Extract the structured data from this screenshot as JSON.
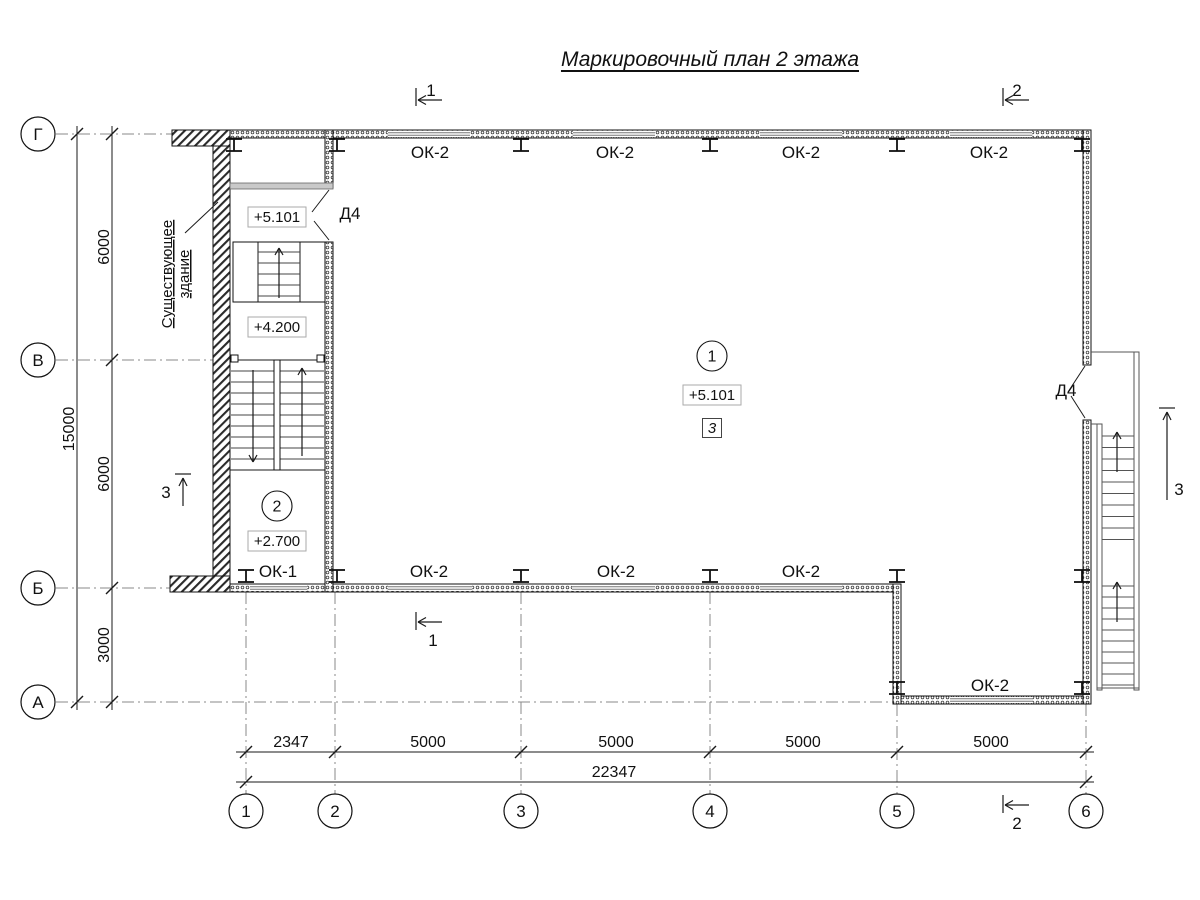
{
  "title": "Маркировочный план 2 этажа",
  "colors": {
    "line": "#1a1a1a",
    "axis_line": "#8a8a8a",
    "wall_hatch": "#2a2a2a"
  },
  "grid": {
    "rows": [
      {
        "label": "Г",
        "y": 134
      },
      {
        "label": "В",
        "y": 360
      },
      {
        "label": "Б",
        "y": 588
      },
      {
        "label": "А",
        "y": 702
      }
    ],
    "cols": [
      {
        "label": "1",
        "x": 246
      },
      {
        "label": "2",
        "x": 335
      },
      {
        "label": "3",
        "x": 521
      },
      {
        "label": "4",
        "x": 710
      },
      {
        "label": "5",
        "x": 897
      },
      {
        "label": "6",
        "x": 1086
      }
    ]
  },
  "dimensions": {
    "left_segments": [
      {
        "text": "6000",
        "y": 247
      },
      {
        "text": "6000",
        "y": 474
      },
      {
        "text": "3000",
        "y": 645
      }
    ],
    "left_overall": {
      "text": "15000",
      "y": 429
    },
    "bottom_segments": [
      {
        "text": "2347",
        "x": 291
      },
      {
        "text": "5000",
        "x": 428
      },
      {
        "text": "5000",
        "x": 616
      },
      {
        "text": "5000",
        "x": 803
      },
      {
        "text": "5000",
        "x": 991
      }
    ],
    "bottom_overall": {
      "text": "22347",
      "x": 614
    }
  },
  "window_marks": [
    {
      "text": "ОК-2",
      "x": 430,
      "y": 152
    },
    {
      "text": "ОК-2",
      "x": 615,
      "y": 152
    },
    {
      "text": "ОК-2",
      "x": 801,
      "y": 152
    },
    {
      "text": "ОК-2",
      "x": 989,
      "y": 152
    },
    {
      "text": "ОК-1",
      "x": 278,
      "y": 571
    },
    {
      "text": "ОК-2",
      "x": 429,
      "y": 571
    },
    {
      "text": "ОК-2",
      "x": 616,
      "y": 571
    },
    {
      "text": "ОК-2",
      "x": 801,
      "y": 571
    },
    {
      "text": "ОК-2",
      "x": 990,
      "y": 685
    }
  ],
  "door_marks": [
    {
      "text": "Д4",
      "x": 350,
      "y": 213
    },
    {
      "text": "Д4",
      "x": 1066,
      "y": 390
    }
  ],
  "level_marks": [
    {
      "text": "+5.101",
      "x": 277,
      "y": 217
    },
    {
      "text": "+4.200",
      "x": 277,
      "y": 327
    },
    {
      "text": "+2.700",
      "x": 277,
      "y": 541
    },
    {
      "text": "+5.101",
      "x": 712,
      "y": 395
    }
  ],
  "room_marks": [
    {
      "text": "1",
      "x": 712,
      "y": 356
    },
    {
      "text": "2",
      "x": 277,
      "y": 506
    }
  ],
  "square_mark": {
    "text": "3",
    "x": 712,
    "y": 428
  },
  "section_marks": [
    {
      "text": "1",
      "orient": "h",
      "tick": [
        416,
        88,
        416,
        106
      ],
      "tail": [
        442,
        100
      ],
      "tip": [
        418,
        100
      ],
      "label": [
        431,
        90
      ]
    },
    {
      "text": "2",
      "orient": "h",
      "tick": [
        1003,
        88,
        1003,
        106
      ],
      "tail": [
        1029,
        100
      ],
      "tip": [
        1005,
        100
      ],
      "label": [
        1017,
        90
      ]
    },
    {
      "text": "1",
      "orient": "h",
      "tick": [
        416,
        612,
        416,
        630
      ],
      "tail": [
        442,
        622
      ],
      "tip": [
        418,
        622
      ],
      "label": [
        433,
        640
      ]
    },
    {
      "text": "2",
      "orient": "h",
      "tick": [
        1003,
        795,
        1003,
        813
      ],
      "tail": [
        1029,
        805
      ],
      "tip": [
        1005,
        805
      ],
      "label": [
        1017,
        823
      ]
    },
    {
      "text": "3",
      "orient": "v",
      "tick": [
        175,
        474,
        191,
        474
      ],
      "tail": [
        183,
        506
      ],
      "tip": [
        183,
        478
      ],
      "label": [
        166,
        492
      ]
    },
    {
      "text": "3",
      "orient": "v",
      "tick": [
        1159,
        408,
        1175,
        408
      ],
      "tail": [
        1167,
        500
      ],
      "tip": [
        1167,
        412
      ],
      "label": [
        1179,
        489
      ]
    }
  ],
  "note": {
    "line1": "Существующее",
    "line2": "здание"
  }
}
